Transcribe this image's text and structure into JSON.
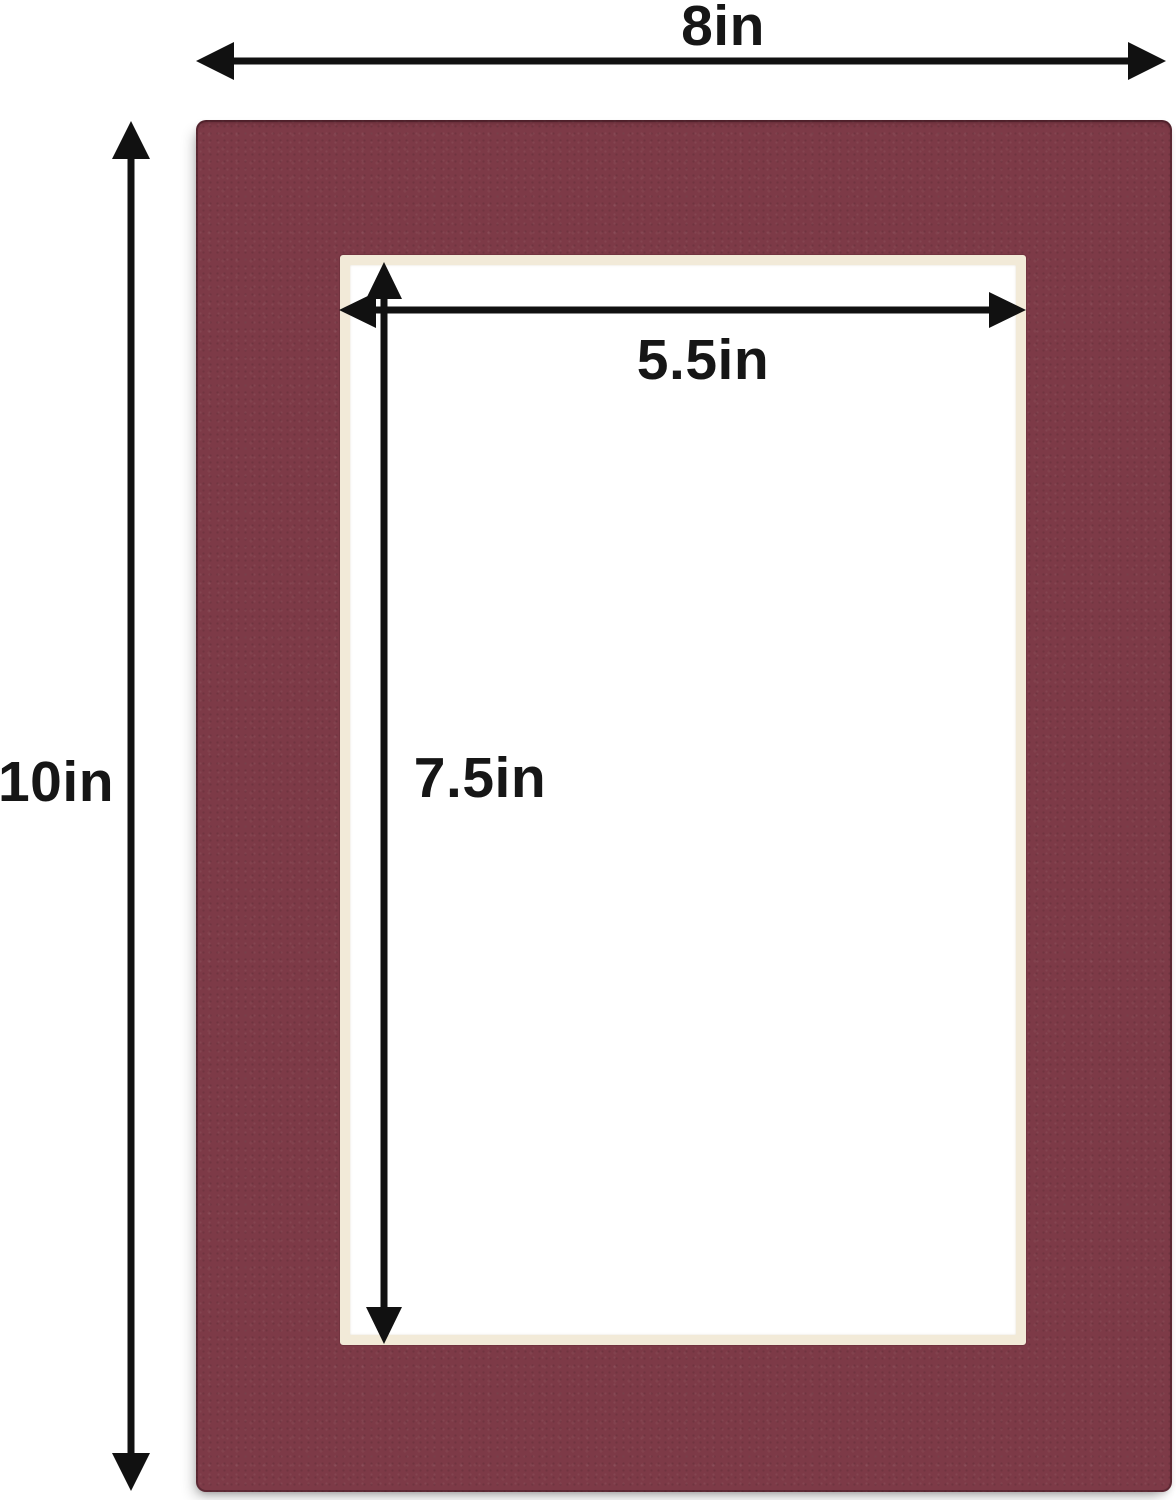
{
  "diagram": {
    "title": "mat-board-dimension-diagram",
    "outer_width_label": "8in",
    "outer_height_label": "10in",
    "opening_width_label": "5.5in",
    "opening_height_label": "7.5in",
    "colors": {
      "mat": "#7d3a47",
      "mat_edge": "#4a1f2a",
      "bevel": "#f2ead8",
      "arrow": "#111111",
      "label": "#161616",
      "background": "#ffffff"
    }
  }
}
